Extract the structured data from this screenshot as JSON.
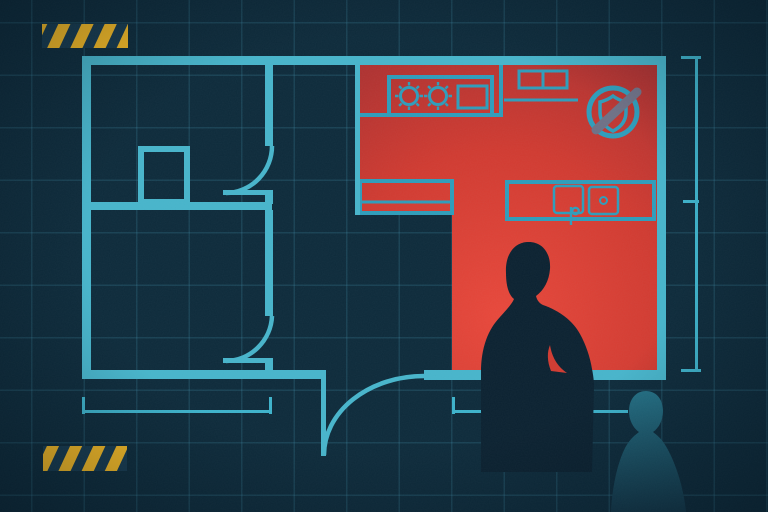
{
  "illustration": {
    "name": "apartment-floor-plan-blueprint-alert",
    "description": "Blueprint floor plan with kitchen highlighted in red, unprotected-shield icon, resident silhouette at kitchen counter, teal observer figure, hazard stripe bars and dimension lines",
    "palette": {
      "background": "#0d2a3a",
      "grid": "#2e7896",
      "wall": "#47b4ca",
      "fixture": "#2e9cba",
      "dimension": "#3db2ca",
      "red_bright": "#e8473a",
      "red_mid": "#d03a30",
      "red_dark": "#a93030",
      "hazard_yellow": "#f2b723",
      "hazard_navy": "#16394e",
      "silhouette": "#0b2130",
      "observer_top": "#237085",
      "observer_bottom": "#123648",
      "slash_gray": "#6e7085"
    },
    "grid": {
      "spacing_px": 52.5
    },
    "floor_plan": {
      "fixtures": [
        "stove-two-burners",
        "oven",
        "upper-cabinets",
        "shelf",
        "side-counter",
        "sink-double-basin",
        "faucet",
        "closet"
      ],
      "doors_count": 3,
      "dimension_lines": [
        "right-vertical",
        "bottom-left-horizontal",
        "bottom-right-horizontal"
      ]
    },
    "icons": [
      {
        "name": "shield-off-icon",
        "meaning": "no protection in kitchen zone"
      }
    ],
    "figures": [
      {
        "name": "resident-silhouette",
        "pose": "standing at kitchen counter"
      },
      {
        "name": "observer-figure",
        "pose": "bust, bottom right"
      }
    ],
    "hazard_bars": [
      {
        "position": "top-left"
      },
      {
        "position": "bottom-left"
      }
    ]
  }
}
